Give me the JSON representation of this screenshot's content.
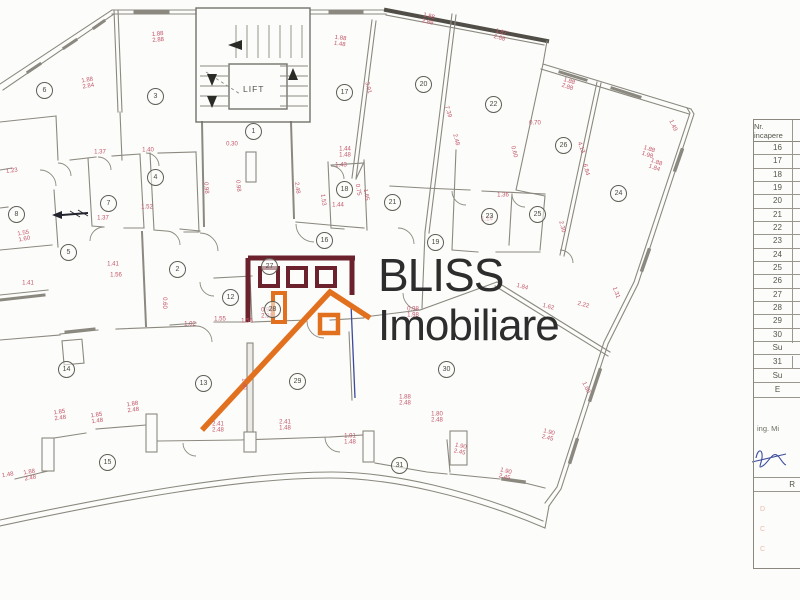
{
  "logo": {
    "brand_top": "BLISS",
    "brand_bottom": "Imobiliare",
    "maroon_color": "#6b222c",
    "orange_color": "#e2711f"
  },
  "plan": {
    "lift_label": "LIFT",
    "dimension_color": "#c25668",
    "rooms": [
      {
        "n": "1",
        "x": 253,
        "y": 131
      },
      {
        "n": "2",
        "x": 177,
        "y": 269
      },
      {
        "n": "3",
        "x": 155,
        "y": 96
      },
      {
        "n": "4",
        "x": 155,
        "y": 177
      },
      {
        "n": "5",
        "x": 68,
        "y": 252
      },
      {
        "n": "6",
        "x": 44,
        "y": 90
      },
      {
        "n": "7",
        "x": 108,
        "y": 203
      },
      {
        "n": "8",
        "x": 16,
        "y": 214
      },
      {
        "n": "12",
        "x": 230,
        "y": 297
      },
      {
        "n": "13",
        "x": 203,
        "y": 383
      },
      {
        "n": "14",
        "x": 66,
        "y": 369
      },
      {
        "n": "15",
        "x": 107,
        "y": 462
      },
      {
        "n": "16",
        "x": 324,
        "y": 240
      },
      {
        "n": "17",
        "x": 344,
        "y": 92
      },
      {
        "n": "18",
        "x": 344,
        "y": 189
      },
      {
        "n": "19",
        "x": 435,
        "y": 242
      },
      {
        "n": "20",
        "x": 423,
        "y": 84
      },
      {
        "n": "21",
        "x": 392,
        "y": 202
      },
      {
        "n": "22",
        "x": 493,
        "y": 104
      },
      {
        "n": "23",
        "x": 489,
        "y": 216
      },
      {
        "n": "24",
        "x": 618,
        "y": 193
      },
      {
        "n": "25",
        "x": 537,
        "y": 214
      },
      {
        "n": "26",
        "x": 563,
        "y": 145
      },
      {
        "n": "27",
        "x": 269,
        "y": 266
      },
      {
        "n": "28",
        "x": 272,
        "y": 309
      },
      {
        "n": "29",
        "x": 297,
        "y": 381
      },
      {
        "n": "30",
        "x": 446,
        "y": 369
      },
      {
        "n": "31",
        "x": 399,
        "y": 465
      }
    ],
    "dimensions": [
      {
        "x": 88,
        "y": 84,
        "t": "1.88\n2.84",
        "r": -10
      },
      {
        "x": 158,
        "y": 38,
        "t": "1.88\n2.88",
        "r": -5
      },
      {
        "x": 340,
        "y": 42,
        "t": "1.88\n1.48",
        "r": 8
      },
      {
        "x": 428,
        "y": 20,
        "t": "1.88\n2.88",
        "r": 14
      },
      {
        "x": 500,
        "y": 36,
        "t": "1.87\n2.88",
        "r": 16
      },
      {
        "x": 568,
        "y": 85,
        "t": "1.88\n2.88",
        "r": 18
      },
      {
        "x": 648,
        "y": 153,
        "t": "1.88\n1.98",
        "r": 18
      },
      {
        "x": 672,
        "y": 126,
        "t": "1.49",
        "r": 65
      },
      {
        "x": 655,
        "y": 166,
        "t": "1.88\n1.84",
        "r": 20
      },
      {
        "x": 561,
        "y": 227,
        "t": "2.30",
        "r": 75
      },
      {
        "x": 535,
        "y": 124,
        "t": "0.70",
        "r": 0
      },
      {
        "x": 580,
        "y": 148,
        "t": "4.13",
        "r": 70
      },
      {
        "x": 585,
        "y": 170,
        "t": "6.84",
        "r": 75
      },
      {
        "x": 12,
        "y": 172,
        "t": "1.23",
        "r": -8
      },
      {
        "x": 100,
        "y": 153,
        "t": "1.37",
        "r": 0
      },
      {
        "x": 148,
        "y": 151,
        "t": "1.40",
        "r": 0
      },
      {
        "x": 103,
        "y": 219,
        "t": "1.37",
        "r": 0
      },
      {
        "x": 147,
        "y": 208,
        "t": "1.52",
        "r": 0
      },
      {
        "x": 24,
        "y": 237,
        "t": "1.55\n1.60",
        "r": -10
      },
      {
        "x": 113,
        "y": 265,
        "t": "1.41",
        "r": 0
      },
      {
        "x": 116,
        "y": 276,
        "t": "1.56",
        "r": 0
      },
      {
        "x": 28,
        "y": 284,
        "t": "1.41",
        "r": 0
      },
      {
        "x": 190,
        "y": 325,
        "t": "1.02",
        "r": 0
      },
      {
        "x": 247,
        "y": 322,
        "t": "1.56",
        "r": 0
      },
      {
        "x": 163,
        "y": 303,
        "t": "0.60",
        "r": 90
      },
      {
        "x": 232,
        "y": 145,
        "t": "0.30",
        "r": 0
      },
      {
        "x": 367,
        "y": 88,
        "t": "3.91",
        "r": 75
      },
      {
        "x": 447,
        "y": 112,
        "t": "7.39",
        "r": 73
      },
      {
        "x": 357,
        "y": 190,
        "t": "0.75",
        "r": 80
      },
      {
        "x": 341,
        "y": 166,
        "t": "1.43",
        "r": 0
      },
      {
        "x": 455,
        "y": 140,
        "t": "2.48",
        "r": 75
      },
      {
        "x": 513,
        "y": 152,
        "t": "0.60",
        "r": 75
      },
      {
        "x": 365,
        "y": 195,
        "t": "1.65",
        "r": 80
      },
      {
        "x": 205,
        "y": 188,
        "t": "0.98",
        "r": 85
      },
      {
        "x": 237,
        "y": 186,
        "t": "0.98",
        "r": 85
      },
      {
        "x": 296,
        "y": 188,
        "t": "2.48",
        "r": 82
      },
      {
        "x": 322,
        "y": 200,
        "t": "1.53",
        "r": 82
      },
      {
        "x": 338,
        "y": 206,
        "t": "1.44",
        "r": 0
      },
      {
        "x": 345,
        "y": 153,
        "t": "1.44\n1.48",
        "r": 0
      },
      {
        "x": 487,
        "y": 220,
        "t": "1.14",
        "r": 0
      },
      {
        "x": 503,
        "y": 196,
        "t": "1.36",
        "r": 0
      },
      {
        "x": 522,
        "y": 288,
        "t": "1.84",
        "r": 15
      },
      {
        "x": 548,
        "y": 308,
        "t": "1.62",
        "r": 15
      },
      {
        "x": 583,
        "y": 306,
        "t": "2.22",
        "r": 15
      },
      {
        "x": 615,
        "y": 293,
        "t": "1.31",
        "r": 70
      },
      {
        "x": 585,
        "y": 388,
        "t": "1.60",
        "r": 65
      },
      {
        "x": 267,
        "y": 314,
        "t": "0.98\n2.98",
        "r": 0
      },
      {
        "x": 413,
        "y": 313,
        "t": "0.98\n1.98",
        "r": 0
      },
      {
        "x": 243,
        "y": 384,
        "t": "1.40",
        "r": 85
      },
      {
        "x": 218,
        "y": 428,
        "t": "2.41\n2.48",
        "r": 0
      },
      {
        "x": 285,
        "y": 426,
        "t": "2.41\n1.48",
        "r": 0
      },
      {
        "x": 350,
        "y": 440,
        "t": "1.91\n1.48",
        "r": 0
      },
      {
        "x": 60,
        "y": 416,
        "t": "1.85\n2.48",
        "r": -8
      },
      {
        "x": 97,
        "y": 419,
        "t": "1.85\n1.48",
        "r": -8
      },
      {
        "x": 133,
        "y": 408,
        "t": "1.88\n2.48",
        "r": -8
      },
      {
        "x": 30,
        "y": 476,
        "t": "1.88\n2.48",
        "r": -10
      },
      {
        "x": 8,
        "y": 476,
        "t": "1.48",
        "r": -10
      },
      {
        "x": 405,
        "y": 401,
        "t": "1.88\n2.48",
        "r": 0
      },
      {
        "x": 437,
        "y": 418,
        "t": "1.80\n2.48",
        "r": 0
      },
      {
        "x": 460,
        "y": 450,
        "t": "1.90\n2.45",
        "r": 12
      },
      {
        "x": 505,
        "y": 475,
        "t": "1.90\n2.45",
        "r": 14
      },
      {
        "x": 548,
        "y": 436,
        "t": "1.90\n2.45",
        "r": 15
      },
      {
        "x": 220,
        "y": 320,
        "t": "1.55",
        "r": 0
      }
    ]
  },
  "table": {
    "header_line1": "Nr.",
    "header_line2": "incapere",
    "room_rows": [
      "16",
      "17",
      "18",
      "19",
      "20",
      "21",
      "22",
      "23",
      "24",
      "25",
      "26",
      "27",
      "28",
      "29",
      "30"
    ],
    "subtotal_label_1": "Su",
    "row_31": "31",
    "subtotal_label_2": "Su",
    "section_e_label": "E",
    "engineer_label": "ing. Mi",
    "section_r_label": "R",
    "stamp_marks": [
      "D",
      "C",
      "C"
    ]
  }
}
